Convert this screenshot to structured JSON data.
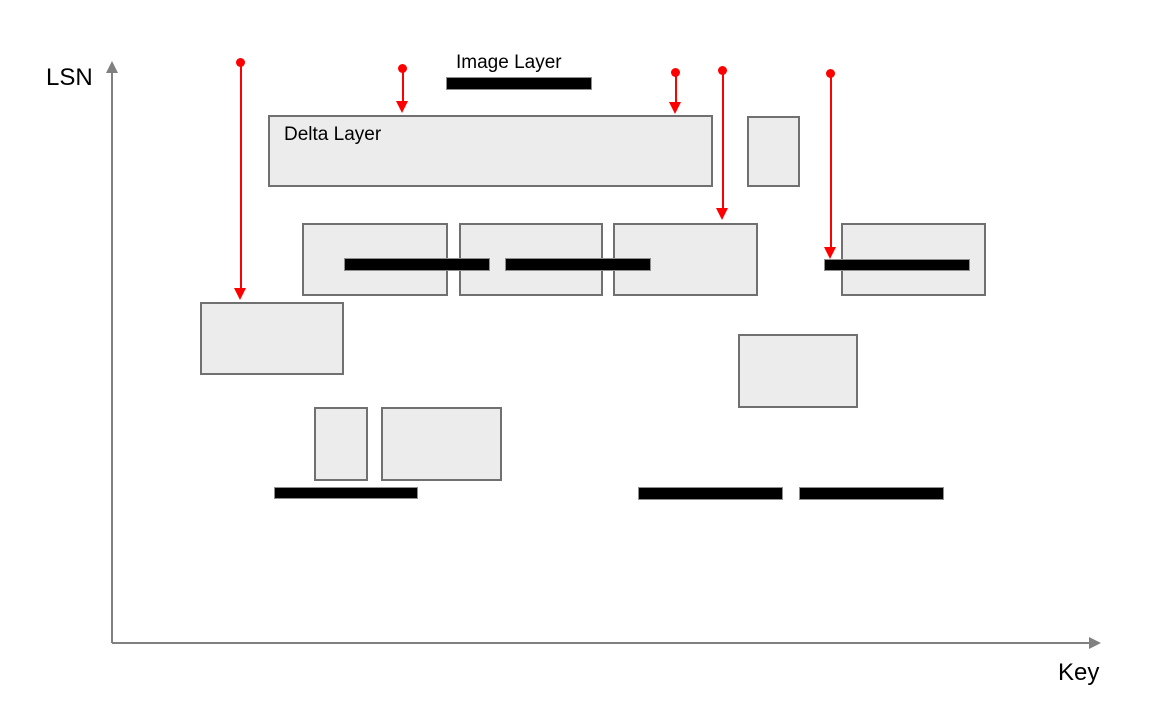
{
  "diagram": {
    "axes": {
      "y_label": "LSN",
      "x_label": "Key"
    },
    "labels": {
      "image_layer": "Image Layer",
      "delta_layer": "Delta Layer"
    },
    "colors": {
      "background": "#ffffff",
      "box_fill": "#ececec",
      "box_stroke": "#707070",
      "bar_fill": "#000000",
      "bar_stroke": "#8f8f8f",
      "arrow": "#ff0000",
      "axis": "#808080",
      "text": "#000000"
    },
    "delta_layer_boxes": [
      {
        "name": "delta-layer-main",
        "x": 268,
        "y": 115,
        "w": 445,
        "h": 72
      },
      {
        "name": "delta-layer-top-right",
        "x": 747,
        "y": 116,
        "w": 53,
        "h": 71
      },
      {
        "name": "delta-layer-mid-1",
        "x": 302,
        "y": 223,
        "w": 146,
        "h": 73
      },
      {
        "name": "delta-layer-mid-2",
        "x": 459,
        "y": 223,
        "w": 144,
        "h": 73
      },
      {
        "name": "delta-layer-mid-3",
        "x": 613,
        "y": 223,
        "w": 145,
        "h": 73
      },
      {
        "name": "delta-layer-mid-4",
        "x": 841,
        "y": 223,
        "w": 145,
        "h": 73
      },
      {
        "name": "delta-layer-left-lower",
        "x": 200,
        "y": 302,
        "w": 144,
        "h": 73
      },
      {
        "name": "delta-layer-right-lower",
        "x": 738,
        "y": 334,
        "w": 120,
        "h": 74
      },
      {
        "name": "delta-layer-small-lower-1",
        "x": 314,
        "y": 407,
        "w": 54,
        "h": 74
      },
      {
        "name": "delta-layer-small-lower-2",
        "x": 381,
        "y": 407,
        "w": 121,
        "h": 74
      }
    ],
    "image_layer_bars": [
      {
        "name": "image-layer-top",
        "x": 446,
        "y": 77,
        "w": 146,
        "h": 13
      },
      {
        "name": "image-layer-mid-1",
        "x": 344,
        "y": 258,
        "w": 146,
        "h": 13
      },
      {
        "name": "image-layer-mid-2",
        "x": 505,
        "y": 258,
        "w": 146,
        "h": 13
      },
      {
        "name": "image-layer-mid-3",
        "x": 824,
        "y": 259,
        "w": 146,
        "h": 12
      },
      {
        "name": "image-layer-bottom-1",
        "x": 274,
        "y": 487,
        "w": 144,
        "h": 12
      },
      {
        "name": "image-layer-bottom-2",
        "x": 638,
        "y": 487,
        "w": 145,
        "h": 13
      },
      {
        "name": "image-layer-bottom-3",
        "x": 799,
        "y": 487,
        "w": 145,
        "h": 13
      }
    ],
    "lookup_arrows": [
      {
        "name": "lookup-arrow-1",
        "x": 241,
        "y_start": 63,
        "y_end": 300
      },
      {
        "name": "lookup-arrow-2",
        "x": 403,
        "y_start": 69,
        "y_end": 113
      },
      {
        "name": "lookup-arrow-3",
        "x": 676,
        "y_start": 73,
        "y_end": 114
      },
      {
        "name": "lookup-arrow-4",
        "x": 723,
        "y_start": 71,
        "y_end": 220
      },
      {
        "name": "lookup-arrow-5",
        "x": 831,
        "y_start": 74,
        "y_end": 259
      }
    ]
  }
}
